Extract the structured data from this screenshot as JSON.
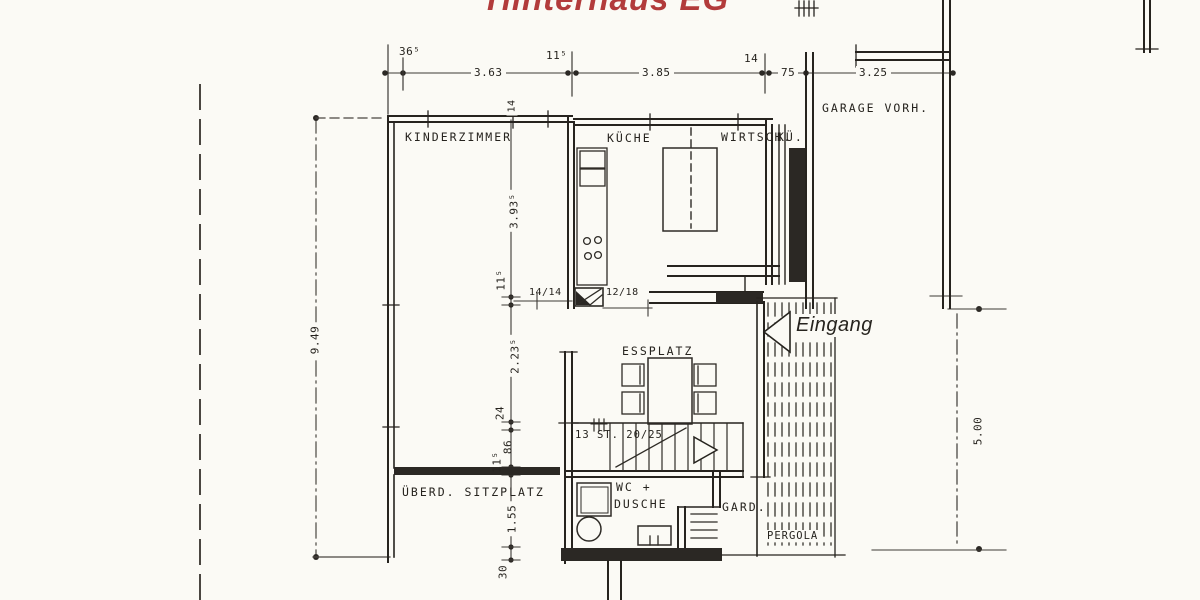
{
  "title": "Hinterhaus EG",
  "rooms": {
    "kinderzimmer": "KINDERZIMMER",
    "kueche": "KÜCHE",
    "wirtschaftskueche_1": "WIRTSCH.",
    "wirtschaftskueche_2": "KÜ.",
    "garage": "GARAGE VORH.",
    "essplatz": "ESSPLATZ",
    "wc_line1": "WC +",
    "wc_line2": "DUSCHE",
    "garderobe": "GARD.",
    "pergola": "PERGOLA",
    "sitzplatz": "ÜBERD. SITZPLATZ",
    "eingang": "Eingang"
  },
  "annotations": {
    "stairs": "13 ST. 20/25",
    "column_left": "14/14",
    "column_right": "12/18",
    "wall_thickness": "14"
  },
  "dimensions": {
    "top": {
      "seg1": "36⁵",
      "w1": "3.63",
      "t1": "11⁵",
      "w2": "3.85",
      "t2": "14",
      "w3": "75",
      "w4": "3.25"
    },
    "left_outer": "9.49",
    "left_chain": {
      "a": "3.93⁵",
      "b": "11⁵",
      "c": "2.23⁵",
      "d": "24",
      "e": "86",
      "f": "11⁵",
      "g": "1.55",
      "h": "30"
    },
    "right": "5.00"
  },
  "colors": {
    "ink": "#2b2824",
    "title_red": "#b23b3b",
    "paper": "#fbfaf5"
  }
}
